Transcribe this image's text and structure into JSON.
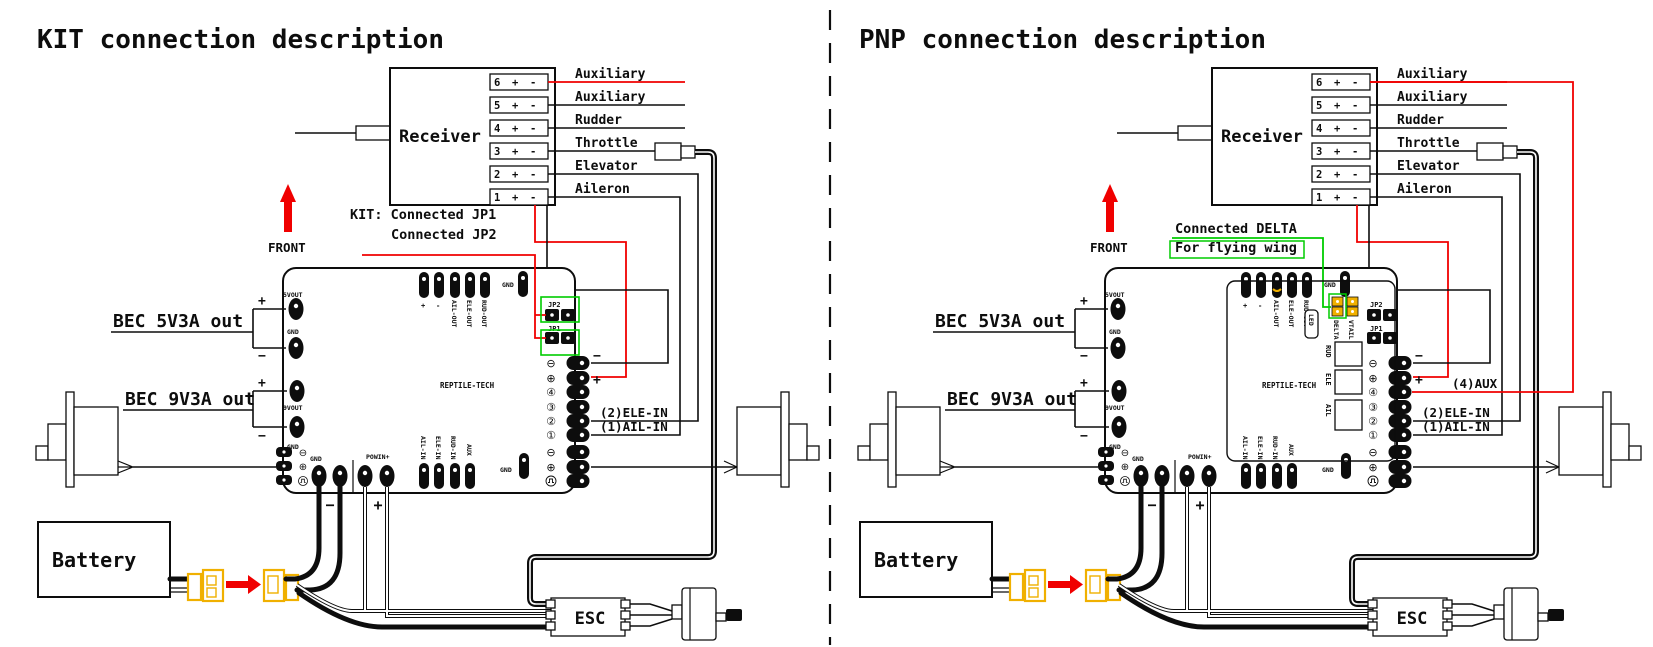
{
  "colors": {
    "wire_red": "#f00000",
    "wire_green": "#00cc00",
    "connector_yellow": "#f0b000"
  },
  "titles": {
    "left": "KIT connection description",
    "right": "PNP connection description"
  },
  "receiver": {
    "label": "Receiver",
    "pin_plus": "+",
    "pin_minus": "-",
    "channels": [
      {
        "num": "6",
        "name": "Auxiliary"
      },
      {
        "num": "5",
        "name": "Auxiliary"
      },
      {
        "num": "4",
        "name": "Rudder"
      },
      {
        "num": "3",
        "name": "Throttle"
      },
      {
        "num": "2",
        "name": "Elevator"
      },
      {
        "num": "1",
        "name": "Aileron"
      }
    ]
  },
  "front_label": "FRONT",
  "notes": {
    "kit_line1": "KIT: Connected JP1",
    "kit_line2": "Connected JP2",
    "pnp_line1": "Connected DELTA",
    "pnp_line2": "For flying wing"
  },
  "bec": {
    "v5": "BEC 5V3A out",
    "v9": "BEC 9V3A out",
    "plus": "+",
    "minus": "−"
  },
  "battery_label": "Battery",
  "esc_label": "ESC",
  "board": {
    "brand": "REPTILE-TECH",
    "pad_5vout": "5VOUT",
    "pad_9vout": "9VOUT",
    "pad_gnd": "GND",
    "top_header": {
      "plus": "+",
      "minus": "-",
      "ail_out": "AIL-OUT",
      "ele_out": "ELE-OUT",
      "rud_out": "RUD-OUT"
    },
    "jp2": "JP2",
    "jp1": "JP1",
    "right_header": {
      "sym_minus": "⊖",
      "sym_plus": "⊕",
      "sym_4": "④",
      "sym_3": "③",
      "sym_2": "②",
      "sym_1": "①",
      "minus": "−",
      "plus": "+"
    },
    "wire_labels": {
      "ele_in": "(2)ELE-IN",
      "ail_in": "(1)AIL-IN",
      "aux": "(4)AUX"
    },
    "powin": "POWIN+",
    "batt_minus": "−",
    "batt_plus": "+",
    "bottom_header": {
      "ail_in": "AIL-IN",
      "ele_in": "ELE-IN",
      "rud_in": "RUD-IN",
      "aux": "AUX"
    },
    "pnp": {
      "led": "LED",
      "delta": "DELTA",
      "vtail": "VTAIL",
      "rud": "RUD",
      "ele": "ELE",
      "ail": "AIL"
    }
  }
}
